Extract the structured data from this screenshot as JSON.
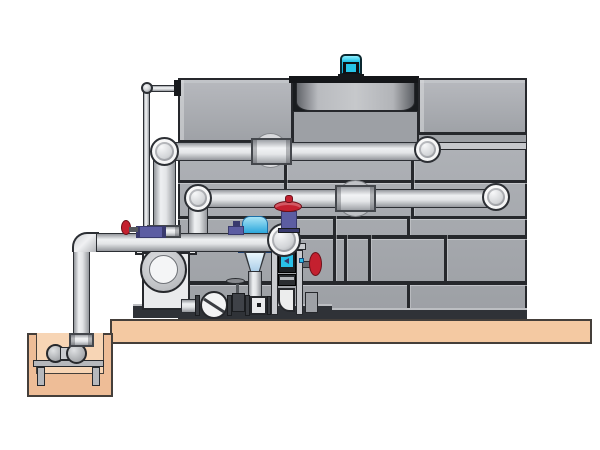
{
  "scene": {
    "type": "technical-illustration",
    "subject": "evaporative-cooling-tower-with-pump-skid-piping-and-sump-pit",
    "background": "#ffffff",
    "visible_text": "none"
  },
  "colors": {
    "ink": "#26282c",
    "tank_light": "#aeb1b6",
    "tank_dark": "#9da0a5",
    "seam": "#26282c",
    "flange_band": "#c6c8cc",
    "cowl_dark": "#191c1f",
    "motor_cyan": "#27c5e8",
    "motor_dark": "#0e1114",
    "pipe_outline": "#2c2f34",
    "platform": "#f4c9a2",
    "earth_outline": "#453f3a",
    "sump_wall": "#eebd97",
    "sump_inner": "#f7d5b5",
    "pump_white": "#e9eaec",
    "steel_light": "#c9cbcf",
    "steel_dark": "#2f3237",
    "valve_red": "#c4202f",
    "valve_red_dark": "#6e1019",
    "valve_purple": "#5c5da2",
    "valve_purple_dark": "#393a6e",
    "strainer_blue": "#2ba7dc",
    "strainer_light": "#a8e4f6",
    "screen_cyan": "#29c0e8"
  },
  "components": [
    "cooling-tower-casing",
    "tower-upper-left-box",
    "fan-cowl",
    "fan-cowl-rim",
    "fan-motor",
    "tower-upper-right-box",
    "tower-panel-wall",
    "upper-supply-pipe",
    "middle-return-pipe",
    "pipe-wall-sleeves",
    "ball-elbows",
    "overflow-pipe",
    "main-suction-header",
    "sump-suction-pipe",
    "concrete-platform",
    "sump-pit",
    "sump-pump",
    "pump-stand",
    "centrifugal-pump",
    "check-valve",
    "gate-valve",
    "inline-strainer-with-funnel",
    "flow-meter-column",
    "digital-flow-meter",
    "red-handwheel-gate-valve",
    "wall-mounted-red-valve",
    "purple-isolation-valves",
    "skid-base-rail"
  ]
}
